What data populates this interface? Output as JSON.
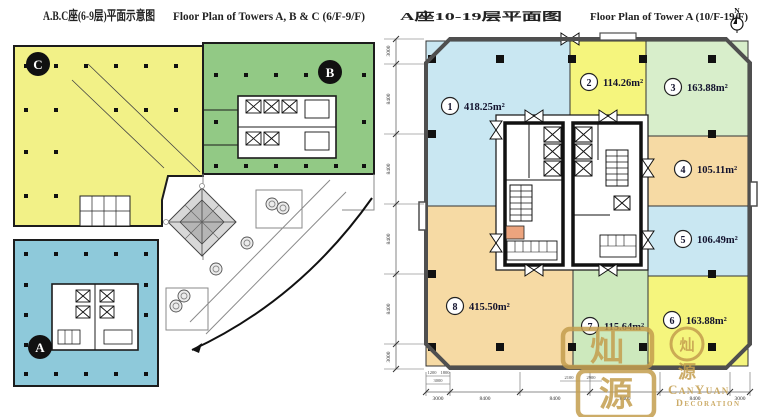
{
  "left_plan": {
    "title_cn": "A.B.C座(6-9层)平面示意图",
    "title_en": "Floor Plan of Towers A, B & C (6/F-9/F)",
    "towers": [
      {
        "label": "A",
        "color": "#8ec9da"
      },
      {
        "label": "B",
        "color": "#92c985"
      },
      {
        "label": "C",
        "color": "#f2f187"
      }
    ]
  },
  "right_plan": {
    "title_cn": "A座10-19层平面图",
    "title_en": "Floor Plan of Tower A (10/F-19/F)",
    "north_label": "N",
    "zones": [
      {
        "no": "1",
        "area": "418.25m²",
        "color": "#c9e7f2"
      },
      {
        "no": "2",
        "area": "114.26m²",
        "color": "#f5f57d"
      },
      {
        "no": "3",
        "area": "163.88m²",
        "color": "#d8eecb"
      },
      {
        "no": "4",
        "area": "105.11m²",
        "color": "#f6daa4"
      },
      {
        "no": "5",
        "area": "106.49m²",
        "color": "#c9e7f2"
      },
      {
        "no": "6",
        "area": "163.88m²",
        "color": "#f5f57d"
      },
      {
        "no": "7",
        "area": "115.64m²",
        "color": "#cde9bd"
      },
      {
        "no": "8",
        "area": "415.50m²",
        "color": "#f6daa4"
      }
    ],
    "dims_left": [
      "3000",
      "8400",
      "8400",
      "8400",
      "8400",
      "3000"
    ],
    "dims_bottom": [
      "3000",
      "8400",
      "8400",
      "8400",
      "8400",
      "3000"
    ],
    "dims_sub": [
      "1200",
      "1800",
      "3000",
      "2100",
      "2900"
    ]
  },
  "watermark": {
    "seal_top": "灿",
    "seal_bottom": "源",
    "emblem_top": "灿",
    "emblem_bottom": "源",
    "name": "CanYuan",
    "subtitle": "Decoration"
  }
}
